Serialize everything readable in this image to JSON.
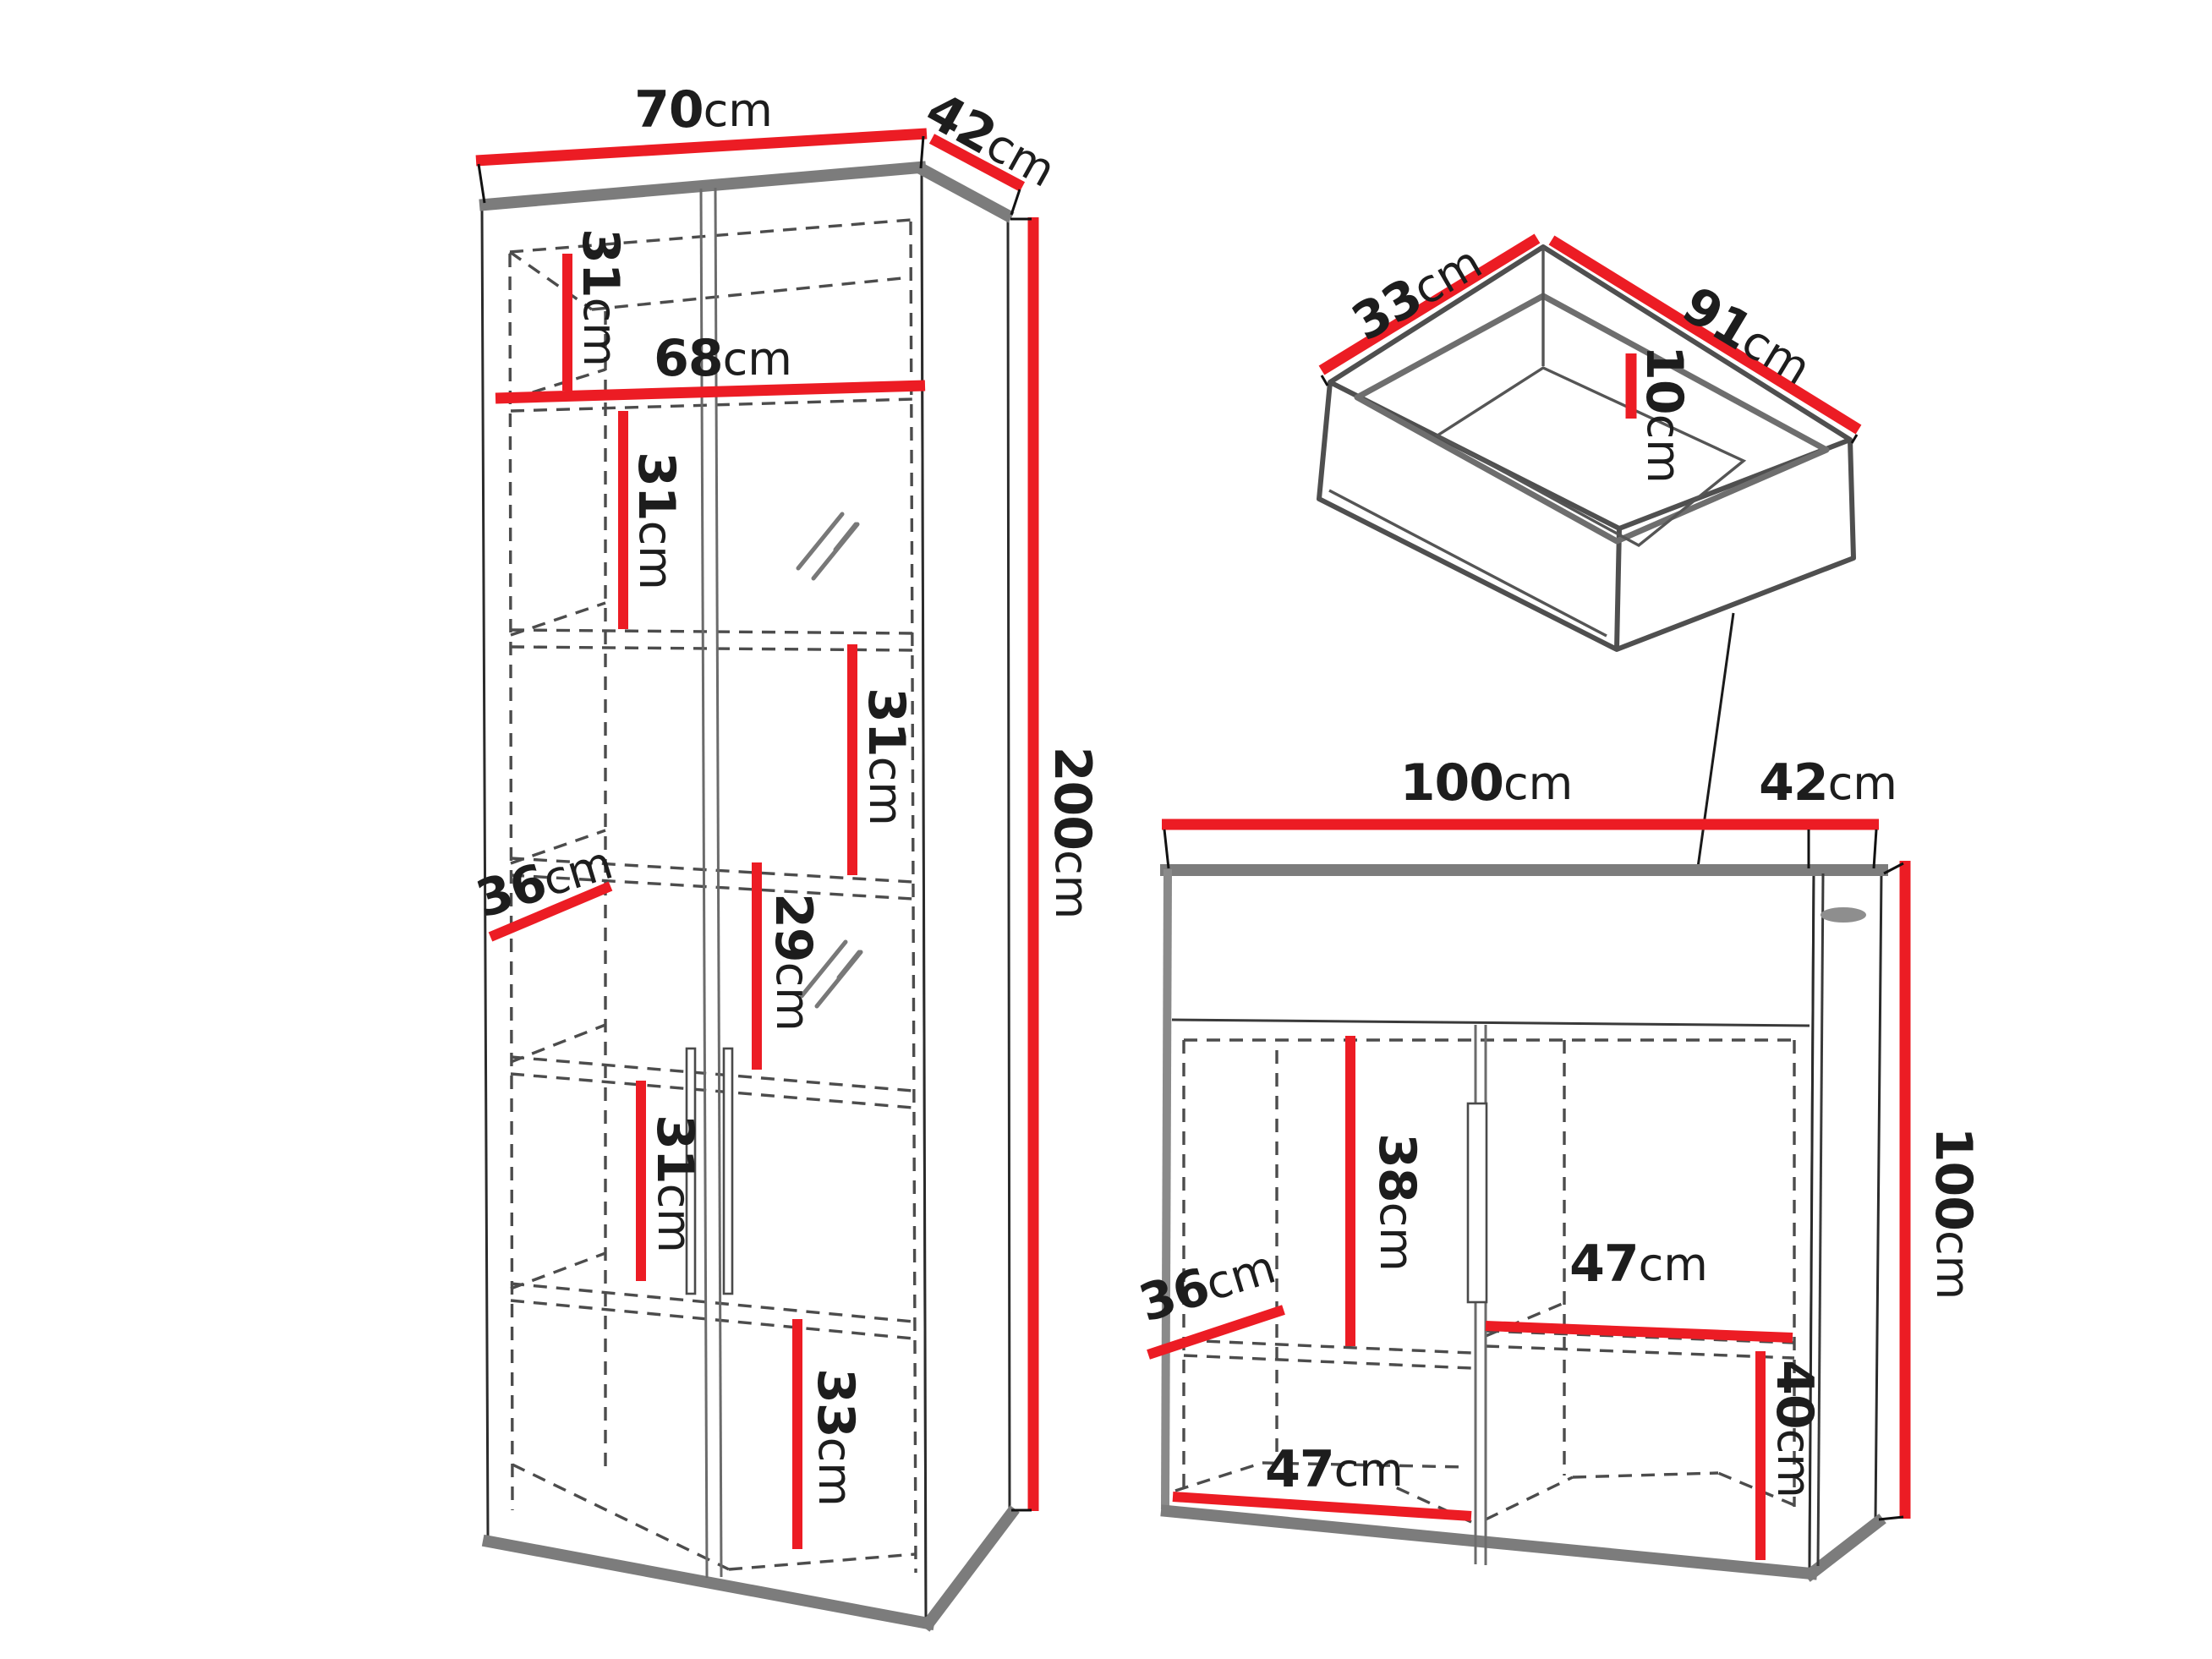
{
  "colors": {
    "dimension_red": "#ec1c24",
    "edge_gray": "#7c7c7c",
    "outline": "#2b2b2b",
    "dashed_gray": "#4c4c4c",
    "text": "#1d1d1d",
    "background": "#ffffff"
  },
  "wardrobe": {
    "width": {
      "num": "70",
      "unit": "cm"
    },
    "depth": {
      "num": "42",
      "unit": "cm"
    },
    "height": {
      "num": "200",
      "unit": "cm"
    },
    "inner_width": {
      "num": "68",
      "unit": "cm"
    },
    "shelf_depth": {
      "num": "36",
      "unit": "cm"
    },
    "sections": [
      {
        "num": "31",
        "unit": "cm"
      },
      {
        "num": "31",
        "unit": "cm"
      },
      {
        "num": "31",
        "unit": "cm"
      },
      {
        "num": "29",
        "unit": "cm"
      },
      {
        "num": "31",
        "unit": "cm"
      },
      {
        "num": "33",
        "unit": "cm"
      }
    ]
  },
  "drawer": {
    "depth": {
      "num": "33",
      "unit": "cm"
    },
    "width": {
      "num": "91",
      "unit": "cm"
    },
    "height": {
      "num": "10",
      "unit": "cm"
    }
  },
  "cabinet": {
    "width": {
      "num": "100",
      "unit": "cm"
    },
    "depth": {
      "num": "42",
      "unit": "cm"
    },
    "height": {
      "num": "100",
      "unit": "cm"
    },
    "inner_height": {
      "num": "38",
      "unit": "cm"
    },
    "shelf_depth": {
      "num": "36",
      "unit": "cm"
    },
    "shelf_width": {
      "num": "47",
      "unit": "cm"
    },
    "bottom_width": {
      "num": "47",
      "unit": "cm"
    },
    "bottom_height": {
      "num": "40",
      "unit": "cm"
    }
  }
}
